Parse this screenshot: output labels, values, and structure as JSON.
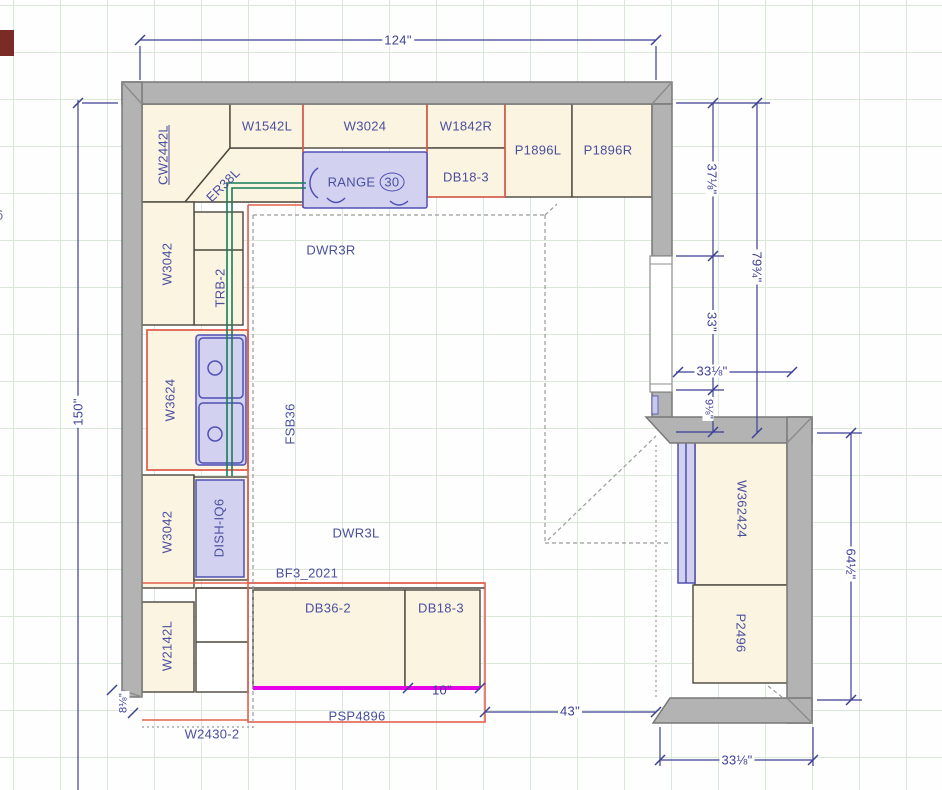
{
  "cabinets": {
    "cw2442l": "CW2442L",
    "w1542l": "W1542L",
    "w3024": "W3024",
    "w1842r": "W1842R",
    "p1896l": "P1896L",
    "p1896r": "P1896R",
    "db18_3_top": "DB18-3",
    "er38l": "ER38L",
    "w3042_upper": "W3042",
    "trb2": "TRB-2",
    "w3624": "W3624",
    "fsb36": "FSB36",
    "dwr3r": "DWR3R",
    "dwr3l": "DWR3L",
    "w3042_lower": "W3042",
    "dish_iq6": "DISH-IQ6",
    "bf3_2021": "BF3_2021",
    "w2142l": "W2142L",
    "db36_2": "DB36-2",
    "db18_3_bottom": "DB18-3",
    "psp4896": "PSP4896",
    "w2430_2": "W2430-2",
    "w362424": "W362424",
    "p2496": "P2496"
  },
  "appliances": {
    "range_label": "RANGE",
    "range_size": "30"
  },
  "dimensions": {
    "top_width": "124\"",
    "left_height": "150\"",
    "right_upper": "37⅛\"",
    "right_overall": "79¾\"",
    "right_window": "33\"",
    "right_opening_width": "33⅛\"",
    "right_lower": "9⅛\"",
    "annex_height": "64½\"",
    "island_to_wall": "43\"",
    "island_overhang": "10\"",
    "annex_width": "33⅛\"",
    "wall_end": "8⅛\""
  },
  "edge_fragment": "6",
  "colors": {
    "wall_gray": "#b3b3b3",
    "cabinet_fill": "#fbf4e0",
    "appliance_fill": "#d2d2f0",
    "appliance_border": "#5050b4",
    "selection_red": "#e4604e",
    "dimension_blue": "#3c3f96",
    "label_blue": "#4a4fa0",
    "plumbing_green": "#177d5b",
    "edge_magenta": "#e800e8",
    "grid_green": "#d9e8d9"
  }
}
